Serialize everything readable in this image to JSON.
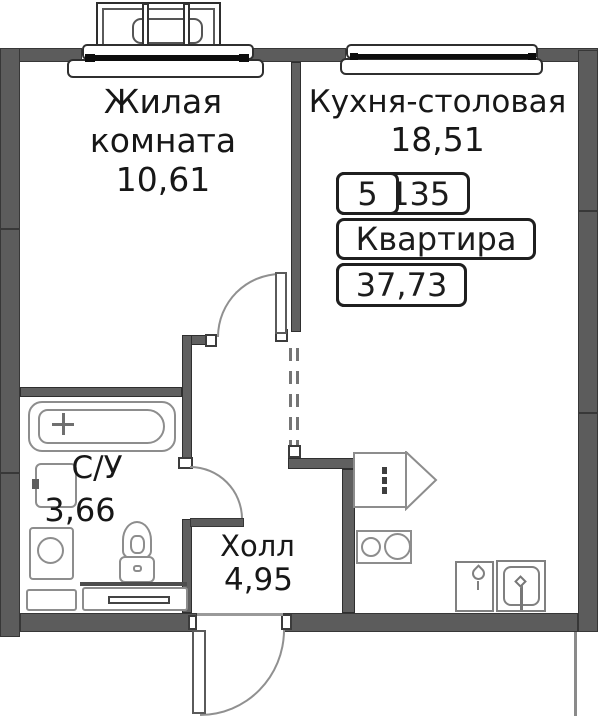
{
  "plan_title": "apartment-floor-plan",
  "labels": {
    "living_line1": "Жилая",
    "living_line2": "комната",
    "living_area": "10,61",
    "kitchen_name": "Кухня-столовая",
    "kitchen_area": "18,51",
    "bathroom_name": "С/У",
    "bathroom_area": "3,66",
    "hall_name": "Холл",
    "hall_area": "4,95"
  },
  "info_table": {
    "unit_number": "№135",
    "floor": "5",
    "kind": "Квартира",
    "rooms": "1к",
    "total_area": "37,73"
  },
  "icons": {
    "bathtub_faucet_icon": "cross",
    "bath_sink_tap_icon": "tick",
    "kitchen_sink_drop_icon": "drop",
    "kitchen_sink_faucet_icon": "faucet",
    "cabinet_door_swing_icon": "triangle-swing"
  },
  "colors": {
    "wall": "#5c5c5c",
    "fixture_outline": "#8d8d8d",
    "text": "#171717",
    "window_line": "#0d0d0d"
  }
}
